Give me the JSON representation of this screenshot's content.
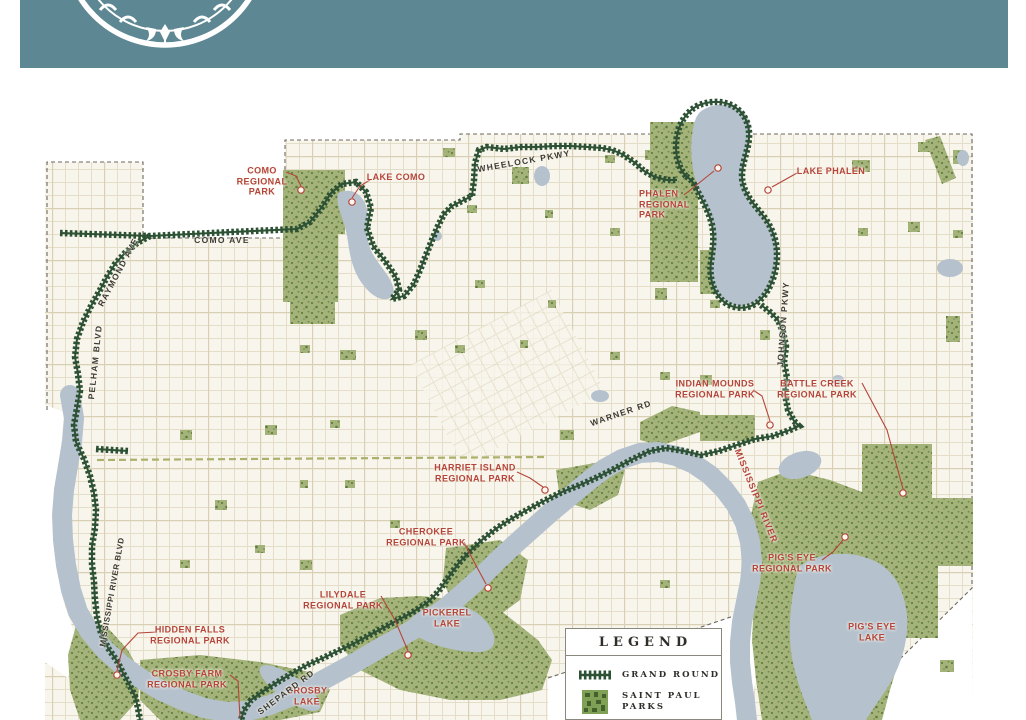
{
  "header": {
    "logo": "saint-paul-city-seal",
    "background_color": "#5d8793"
  },
  "map": {
    "colors": {
      "land": "#f8f5ec",
      "outside": "#ffffff",
      "water": "#b5c2cd",
      "park": "#a4b37a",
      "route": "#2d5134",
      "park_label": "#b5453a",
      "road_label": "#3b3a33",
      "boundary": "#6b695f"
    },
    "park_labels": [
      {
        "id": "como",
        "text": "COMO\nREGIONAL\nPARK"
      },
      {
        "id": "lake-como",
        "text": "LAKE COMO"
      },
      {
        "id": "phalen",
        "text": "PHALEN\nREGIONAL\nPARK"
      },
      {
        "id": "lake-phalen",
        "text": "LAKE PHALEN"
      },
      {
        "id": "indian-mounds",
        "text": "INDIAN MOUNDS\nREGIONAL PARK"
      },
      {
        "id": "battle-creek",
        "text": "BATTLE CREEK\nREGIONAL PARK"
      },
      {
        "id": "harriet-island",
        "text": "HARRIET ISLAND\nREGIONAL PARK"
      },
      {
        "id": "cherokee",
        "text": "CHEROKEE\nREGIONAL PARK"
      },
      {
        "id": "lilydale",
        "text": "LILYDALE\nREGIONAL PARK"
      },
      {
        "id": "pickerel-lake",
        "text": "PICKEREL\nLAKE"
      },
      {
        "id": "hidden-falls",
        "text": "HIDDEN FALLS\nREGIONAL PARK"
      },
      {
        "id": "crosby-farm",
        "text": "CROSBY FARM\nREGIONAL PARK"
      },
      {
        "id": "crosby-lake",
        "text": "CROSBY\nLAKE"
      },
      {
        "id": "pigs-eye-park",
        "text": "PIG'S EYE\nREGIONAL PARK"
      },
      {
        "id": "pigs-eye-lake",
        "text": "PIG'S EYE\nLAKE"
      },
      {
        "id": "mississippi-river",
        "text": "MISSISSIPPI RIVER"
      }
    ],
    "road_labels": [
      {
        "id": "wheelock-pkwy",
        "text": "WHEELOCK  PKWY"
      },
      {
        "id": "como-ave",
        "text": "COMO  AVE"
      },
      {
        "id": "raymond-ave",
        "text": "RAYMOND  AVE"
      },
      {
        "id": "pelham-blvd",
        "text": "PELHAM  BLVD"
      },
      {
        "id": "johnson-pkwy",
        "text": "JOHNSON  PKWY"
      },
      {
        "id": "warner-rd",
        "text": "WARNER  RD"
      },
      {
        "id": "mississippi-river-blvd",
        "text": "MISSISSIPPI  RIVER  BLVD"
      },
      {
        "id": "shepard-rd",
        "text": "SHEPARD  RD"
      }
    ]
  },
  "legend": {
    "title": "LEGEND",
    "items": [
      {
        "label": "GRAND ROUND",
        "swatch": "grand-round-route-line"
      },
      {
        "label": "SAINT PAUL\nPARKS",
        "swatch": "saint-paul-parks-texture"
      }
    ]
  }
}
